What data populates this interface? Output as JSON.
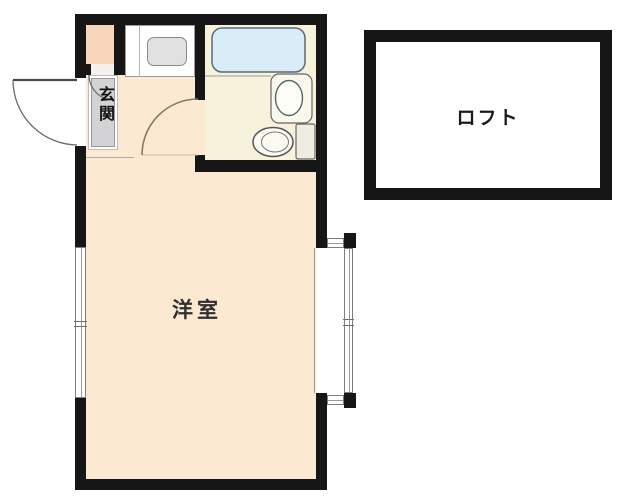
{
  "plan": {
    "rooms": {
      "main_room": {
        "label": "洋室",
        "floor_color": "#fce9d1"
      },
      "loft": {
        "label": "ロフト",
        "floor_color": "#ffffff"
      },
      "entrance": {
        "label": "玄関",
        "mat_color": "#d3d3d5"
      },
      "bathroom": {
        "floor_color": "#f6f2dc"
      },
      "closet": {
        "floor_color": "#f8d6bc"
      }
    },
    "colors": {
      "wall": "#161616",
      "background": "#ffffff",
      "bathtub": "#d9ecf8",
      "kitchen_sink": "#e1e1e1",
      "door_arc": "#8a7566"
    },
    "fixtures": [
      "bathtub",
      "washbasin",
      "toilet",
      "kitchen-sink"
    ],
    "openings": [
      "entrance-door",
      "room-door",
      "closet-door",
      "left-window",
      "bay-window"
    ]
  }
}
